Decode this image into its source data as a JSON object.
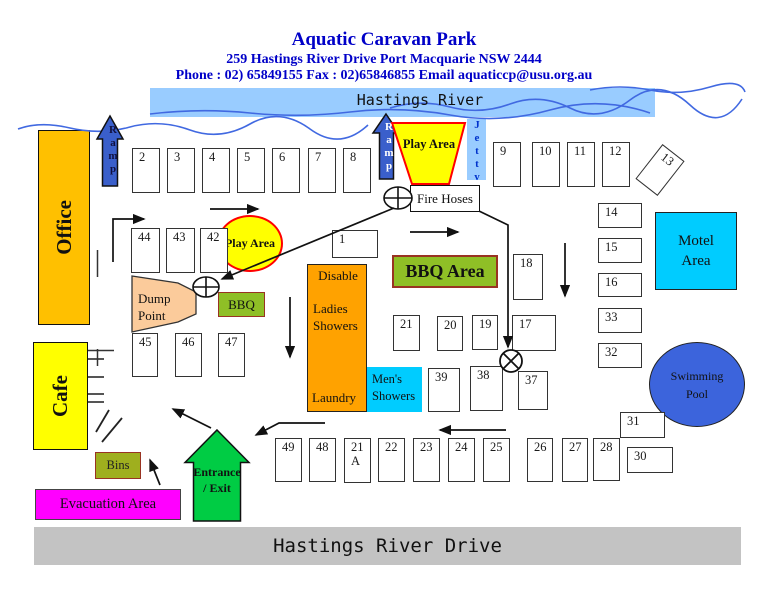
{
  "header": {
    "title": "Aquatic Caravan Park",
    "address": "259 Hastings River Drive Port Macquarie NSW 2444",
    "contact": "Phone : 02) 65849155 Fax : 02)65846855 Email aquaticcp@usu.org.au"
  },
  "river": {
    "label": "Hastings River"
  },
  "road": {
    "label": "Hastings River Drive"
  },
  "areas": {
    "office": "Office",
    "cafe": "Cafe",
    "ramp1": "Ramp",
    "ramp2": "Ramp",
    "jetty": "Jetty",
    "play_area_top": "Play Area",
    "play_area_mid": "Play Area",
    "fire_hoses": "Fire Hoses",
    "dump_point": "Dump Point",
    "bbq_small": "BBQ",
    "bbq_area": "BBQ Area",
    "disable": "Disable",
    "ladies_showers": "Ladies Showers",
    "laundry": "Laundry",
    "mens_showers": "Men's Showers",
    "motel_area": "Motel Area",
    "swimming_pool": "Swimming Pool",
    "bins": "Bins",
    "entrance_exit": "Entrance / Exit",
    "evacuation_area": "Evacuation Area"
  },
  "colors": {
    "header_blue": "#0000C8",
    "river_band": "#99CCFF",
    "wave_blue": "#4169E1",
    "office_gold": "#FFC000",
    "ramp_blue": "#3A5FCB",
    "play_yellow": "#FFFF00",
    "play_border_red": "#FF0000",
    "bbq_green": "#8FBF26",
    "bbq_border": "#993322",
    "showers_orange": "#FFA200",
    "cyan_area": "#00CCFF",
    "pool_blue": "#3C64DC",
    "dump_peach": "#FBCB9B",
    "entrance_green": "#00CC44",
    "evacuation_magenta": "#FF00FF",
    "road_gray": "#C3C3C3"
  },
  "sites": [
    {
      "label": "2",
      "x": 132,
      "y": 148,
      "w": 28,
      "h": 45
    },
    {
      "label": "3",
      "x": 167,
      "y": 148,
      "w": 28,
      "h": 45
    },
    {
      "label": "4",
      "x": 202,
      "y": 148,
      "w": 28,
      "h": 45
    },
    {
      "label": "5",
      "x": 237,
      "y": 148,
      "w": 28,
      "h": 45
    },
    {
      "label": "6",
      "x": 272,
      "y": 148,
      "w": 28,
      "h": 45
    },
    {
      "label": "7",
      "x": 308,
      "y": 148,
      "w": 28,
      "h": 45
    },
    {
      "label": "8",
      "x": 343,
      "y": 148,
      "w": 28,
      "h": 45
    },
    {
      "label": "9",
      "x": 493,
      "y": 142,
      "w": 28,
      "h": 45
    },
    {
      "label": "10",
      "x": 532,
      "y": 142,
      "w": 28,
      "h": 45
    },
    {
      "label": "11",
      "x": 567,
      "y": 142,
      "w": 28,
      "h": 45
    },
    {
      "label": "12",
      "x": 602,
      "y": 142,
      "w": 28,
      "h": 45
    },
    {
      "label": "13",
      "x": 646,
      "y": 148,
      "w": 28,
      "h": 44,
      "rot": 38
    },
    {
      "label": "1",
      "x": 332,
      "y": 230,
      "w": 46,
      "h": 28
    },
    {
      "label": "44",
      "x": 131,
      "y": 228,
      "w": 29,
      "h": 45
    },
    {
      "label": "43",
      "x": 166,
      "y": 228,
      "w": 29,
      "h": 45
    },
    {
      "label": "42",
      "x": 200,
      "y": 228,
      "w": 28,
      "h": 45
    },
    {
      "label": "45",
      "x": 132,
      "y": 333,
      "w": 26,
      "h": 44
    },
    {
      "label": "46",
      "x": 175,
      "y": 333,
      "w": 27,
      "h": 44
    },
    {
      "label": "47",
      "x": 218,
      "y": 333,
      "w": 27,
      "h": 44
    },
    {
      "label": "18",
      "x": 513,
      "y": 254,
      "w": 30,
      "h": 46
    },
    {
      "label": "21",
      "x": 393,
      "y": 315,
      "w": 27,
      "h": 36
    },
    {
      "label": "20",
      "x": 437,
      "y": 316,
      "w": 26,
      "h": 35
    },
    {
      "label": "19",
      "x": 472,
      "y": 315,
      "w": 26,
      "h": 35
    },
    {
      "label": "17",
      "x": 512,
      "y": 315,
      "w": 44,
      "h": 36
    },
    {
      "label": "39",
      "x": 428,
      "y": 368,
      "w": 32,
      "h": 44
    },
    {
      "label": "38",
      "x": 470,
      "y": 366,
      "w": 33,
      "h": 45
    },
    {
      "label": "37",
      "x": 518,
      "y": 371,
      "w": 30,
      "h": 39
    },
    {
      "label": "14",
      "x": 598,
      "y": 203,
      "w": 44,
      "h": 25
    },
    {
      "label": "15",
      "x": 598,
      "y": 238,
      "w": 44,
      "h": 25
    },
    {
      "label": "16",
      "x": 598,
      "y": 273,
      "w": 44,
      "h": 24
    },
    {
      "label": "33",
      "x": 598,
      "y": 308,
      "w": 44,
      "h": 25
    },
    {
      "label": "32",
      "x": 598,
      "y": 343,
      "w": 44,
      "h": 25
    },
    {
      "label": "49",
      "x": 275,
      "y": 438,
      "w": 27,
      "h": 44
    },
    {
      "label": "48",
      "x": 309,
      "y": 438,
      "w": 27,
      "h": 44
    },
    {
      "label": "21 A",
      "x": 344,
      "y": 438,
      "w": 27,
      "h": 45
    },
    {
      "label": "22",
      "x": 378,
      "y": 438,
      "w": 27,
      "h": 44
    },
    {
      "label": "23",
      "x": 413,
      "y": 438,
      "w": 27,
      "h": 44
    },
    {
      "label": "24",
      "x": 448,
      "y": 438,
      "w": 27,
      "h": 44
    },
    {
      "label": "25",
      "x": 483,
      "y": 438,
      "w": 27,
      "h": 44
    },
    {
      "label": "26",
      "x": 527,
      "y": 438,
      "w": 26,
      "h": 44
    },
    {
      "label": "27",
      "x": 562,
      "y": 438,
      "w": 26,
      "h": 44
    },
    {
      "label": "28",
      "x": 593,
      "y": 438,
      "w": 27,
      "h": 43
    },
    {
      "label": "31",
      "x": 620,
      "y": 412,
      "w": 45,
      "h": 26
    },
    {
      "label": "30",
      "x": 627,
      "y": 447,
      "w": 46,
      "h": 26
    }
  ]
}
